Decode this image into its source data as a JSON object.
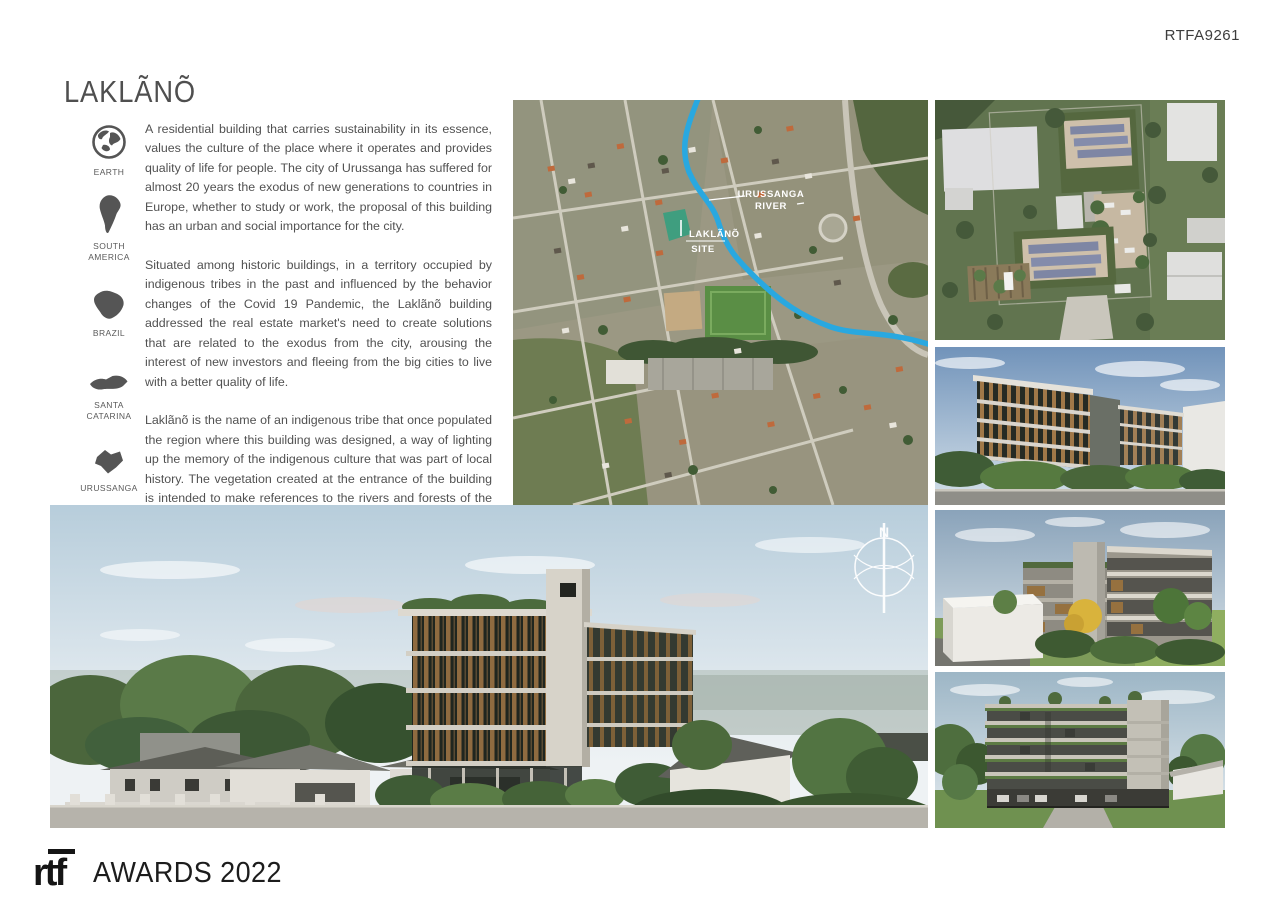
{
  "header": {
    "ref_code": "RTFA9261"
  },
  "project": {
    "title": "LAKLÃNÕ"
  },
  "location_markers": [
    {
      "icon": "earth-globe-icon",
      "label": "EARTH"
    },
    {
      "icon": "south-america-map-icon",
      "label": "SOUTH AMERICA"
    },
    {
      "icon": "brazil-map-icon",
      "label": "BRAZIL"
    },
    {
      "icon": "santa-catarina-map-icon",
      "label": "SANTA CATARINA"
    },
    {
      "icon": "urussanga-map-icon",
      "label": "URUSSANGA"
    }
  ],
  "description": {
    "paragraph_1": "A residential building that carries sustainability in its essence, values the culture of the place where it operates and provides quality of life for people. The city of Urussanga has suffered for almost 20 years the exodus of new generations to countries in Europe, whether to study or work, the proposal of this building has an urban and social importance for the city.",
    "paragraph_2": "Situated among historic buildings, in a territory occupied by indigenous tribes in the past and influenced by the behavior changes of the Covid 19 Pandemic, the Laklãnõ building addressed the real estate market's need to create solutions that are related to the exodus from the city, arousing the interest of new investors and fleeing from the big cities to live with a better quality of life.",
    "paragraph_3": "Laklãnõ is the name of an indigenous tribe that once populated the region where this building was designed, a way of lighting up the memory of the indigenous culture that was part of local history. The vegetation created at the entrance of the building is intended to make references to the rivers and forests of the region, which served for many years as food and survival for the ancient tribes, so it rescues the local trees and shrubs such as araçá, palms and ipê among others to further reinforce the region and encourage the visit of native birds such as the orange thrush and the local canary."
  },
  "aerial_map": {
    "river_label_line_1": "URUSSANGA",
    "river_label_line_2": "RIVER",
    "site_label_line_1": "LAKLÃNÕ",
    "site_label_line_2": "SITE"
  },
  "compass": {
    "north": "N"
  },
  "footer": {
    "logo": "rtf",
    "awards": "AWARDS 2022"
  },
  "colors": {
    "river_blue": "#29a8e0",
    "site_green": "#3f9e7f"
  }
}
